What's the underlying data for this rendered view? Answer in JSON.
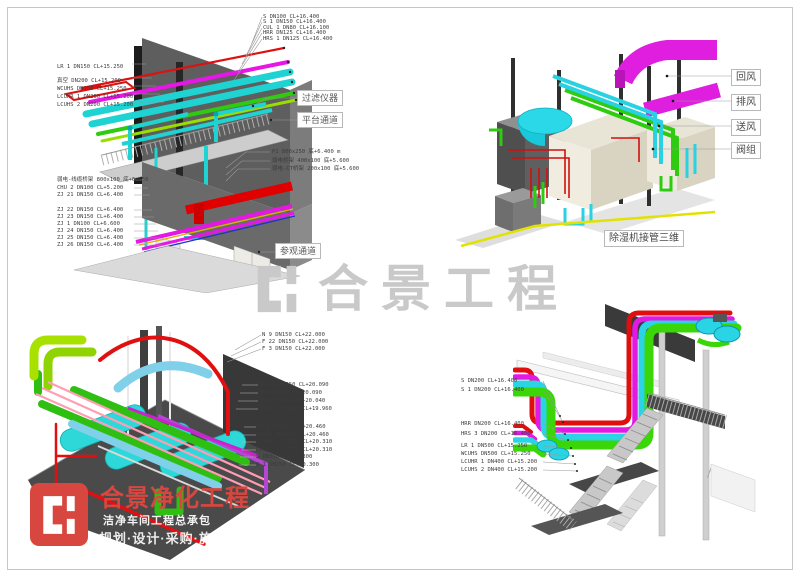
{
  "watermark": {
    "text": "合景工程"
  },
  "brand": {
    "title": "合景净化工程",
    "subtitle": "洁净车间工程总承包",
    "services": "规划·设计·采购·施工·维保",
    "brand_red": "#d8473f",
    "watermark_gray": "#c9c9c9"
  },
  "palette": {
    "magenta": "#e617e6",
    "cyan": "#1fd3d3",
    "green": "#2ecb10",
    "red": "#e00000",
    "yellow_green": "#9ade00",
    "sky_blue": "#7fd0e8",
    "pink": "#ff9db5",
    "violet": "#b545d5",
    "yellow": "#e2e200"
  },
  "view_tl": {
    "callout_filter": "过滤仪器",
    "callout_platform": "平台通道",
    "callout_visit": "参观通道",
    "labels_top": [
      "S DN100 CL+16.400",
      "S 1 DN150 CL+16.400",
      "CUL 1 DN80 CL+16.100",
      "HRR DN125 CL+16.400",
      "HRS 1 DN125 CL+16.400"
    ],
    "labels_left_upper": [
      "LR 1 DN150 CL+15.250",
      "真空 DN200 CL+15.200",
      "WCUHS DN150 CL+15.250",
      "LCUHR 1 DN200 CL+15.200",
      "LCUHS 2 DN200 CL+15.200"
    ],
    "labels_left_lower": [
      "弱电-线缆桥架 800x100 底+6.650",
      "CHU 2 DN100 CL+5.200",
      "ZJ 21 DN150 CL+6.400",
      "ZJ 22 DN150 CL+6.400",
      "ZJ 23 DN150 CL+6.400",
      "ZJ 1 DN100 CL+6.600",
      "ZJ 24 DN150 CL+6.400",
      "ZJ 25 DN150 CL+6.400",
      "ZJ 26 DN150 CL+6.400"
    ],
    "labels_mid": [
      "P1 800x250 底+6.400 m",
      "弱电桥架 400x100 底+5.600",
      "弱电-CT桥架 200x100 底+5.600"
    ]
  },
  "view_tr": {
    "callouts": [
      "回风",
      "排风",
      "送风",
      "阀组"
    ],
    "caption": "除湿机接管三维"
  },
  "view_bl": {
    "labels_top": [
      "N 9 DN150 CL+22.000",
      "F 22 DN150 CL+22.000",
      "F 3 DN150 CL+22.000"
    ],
    "labels_mid": [
      "HRS 3 DN250 CL+20.090",
      "HRR DN250 CL+20.090",
      "CW 1 DN250 CL+20.040",
      "NXWP 1 DN100 CL+19.960"
    ],
    "labels_low": [
      "LR 1 DN1000 CL+20.460",
      "WCUHS DN1000 CL+20.460",
      "LCUHR 1 DN700 CL+20.310",
      "LCUHS 2 DN700 CL+20.310",
      "S DN350 CL+20.300",
      "S 1 DN250 CL+20.300"
    ]
  },
  "view_br": {
    "labels": [
      "S DN200 CL+16.400",
      "S 1 DN200 CL+16.400",
      "HRR DN200 CL+16.400",
      "HRS 3 DN200 CL+16.400",
      "LR 1 DN500 CL+15.250",
      "WCUHS DN500 CL+15.250",
      "LCUHR 1 DN400 CL+15.200",
      "LCUHS 2 DN400 CL+15.200"
    ]
  }
}
